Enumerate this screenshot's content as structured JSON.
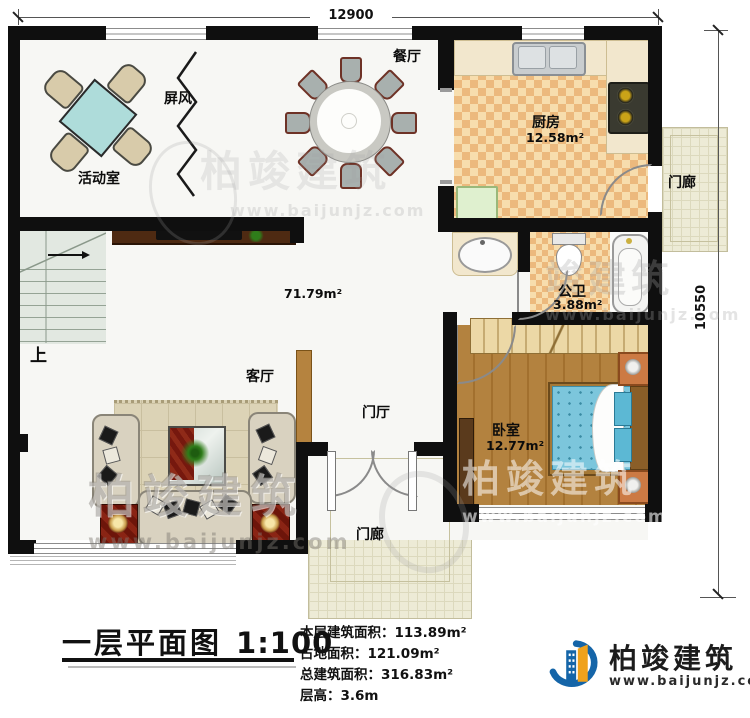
{
  "dimensions": {
    "width": "12900",
    "height": "10550"
  },
  "rooms": {
    "activity": {
      "label": "活动室"
    },
    "screen": {
      "label": "屏风"
    },
    "dining": {
      "label": "餐厅"
    },
    "kitchen": {
      "label": "厨房",
      "area": "12.58m²"
    },
    "porch_right": {
      "label": "门廊"
    },
    "bath": {
      "label": "公卫",
      "area": "3.88m²"
    },
    "bedroom": {
      "label": "卧室",
      "area": "12.77m²"
    },
    "living": {
      "label": "客厅"
    },
    "foyer": {
      "label": "门厅"
    },
    "porch_bottom": {
      "label": "门廊"
    },
    "stairs": {
      "label": "上"
    },
    "open_area": {
      "area": "71.79m²"
    }
  },
  "title_block": {
    "title": "一层平面图",
    "scale": "1:100",
    "stats": [
      {
        "label": "本层建筑面积：",
        "value": "113.89m²"
      },
      {
        "label": "占地面积：",
        "value": "121.09m²"
      },
      {
        "label": "总建筑面积：",
        "value": "316.83m²"
      },
      {
        "label": "层高：",
        "value": "3.6m"
      }
    ]
  },
  "logo": {
    "name": "柏竣建筑",
    "website": "www.baijunjz.com"
  },
  "watermark": {
    "name": "柏竣建筑",
    "partial": "竣建筑",
    "website": "www.baijunjz.com"
  },
  "colors": {
    "wall": "#0f0f0f",
    "kitchen_floor": "#ecb97d",
    "bedroom_floor": "#b3823f",
    "porch_floor": "#edebd6",
    "logo_blue": "#1565a8",
    "logo_orange": "#f0a21c"
  }
}
